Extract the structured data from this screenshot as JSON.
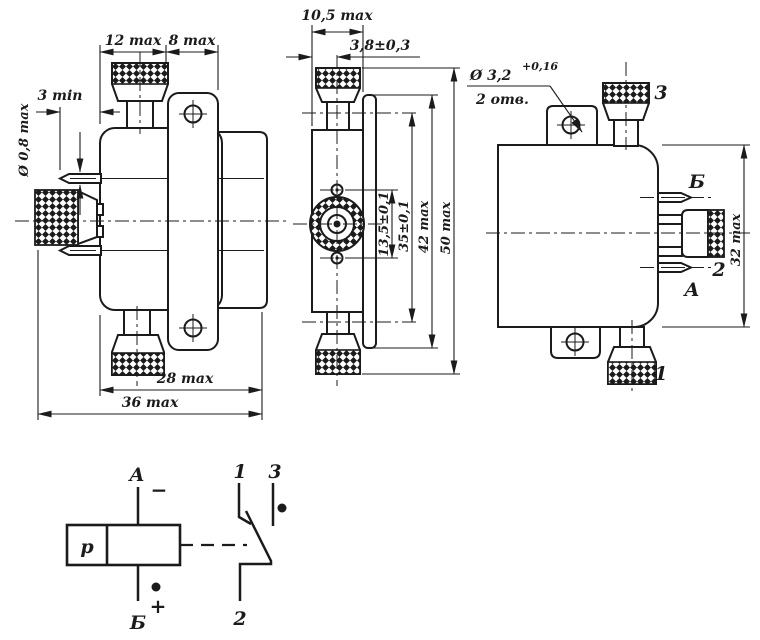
{
  "front": {
    "d12": "12 max",
    "d8": "8 max",
    "d3": "3 min",
    "d08": "Ø 0,8 max",
    "d28": "28 max",
    "d36": "36 max"
  },
  "side": {
    "d105": "10,5 max",
    "d38": "3,8±0,3",
    "d135": "13,5±0,1",
    "d35": "35±0,1",
    "d42": "42 max",
    "d50": "50 max"
  },
  "back": {
    "d32": "32 max",
    "hole_dia": "Ø 3,2",
    "hole_tol": "+0,16",
    "hole_qty": "2 отв.",
    "knob_top": "3",
    "knob_bottom": "1",
    "pin_upper": "Б",
    "pin_lower": "2",
    "pin_coil": "А"
  },
  "schematic": {
    "coil": "р",
    "term_top": "А",
    "term_bottom": "Б",
    "minus": "−",
    "plus": "+",
    "c1": "1",
    "c2": "2",
    "c3": "3"
  },
  "colors": {
    "ink": "#1b1b1b",
    "paper": "#ffffff"
  }
}
